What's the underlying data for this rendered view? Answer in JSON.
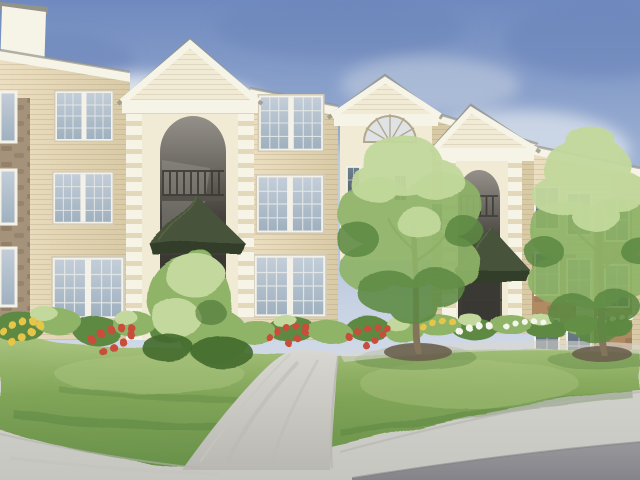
{
  "scene": {
    "description": "Watercolor architectural rendering of a three-story apartment complex with cream gabled entry towers, tan lap siding and stone accents, landscaped lawn with red, yellow and white flower beds, shrubs, two young trees, a curved concrete walkway and a street in the foreground under a hazy blue sky",
    "labels": {
      "sky": "hazy blue watercolor sky with soft clouds",
      "left_wing": "left apartment wing with tan siding and stone column",
      "left_entry": "tall gabled entry tower with arched breezeway, balcony railings and dark green pyramidal awning",
      "center_gable": "center gable tower with semicircular fan window",
      "right_entry": "second gabled entry tower with arch and dark green awning",
      "right_wing": "right apartment wing with stone veneer, partly hidden by a tree",
      "flower_beds": "foundation beds with yellow, red and white flowers",
      "entry_shrub": "bright green shrub in front of the left entry",
      "trees": "two young deciduous trees on lawn mounds",
      "lawn": "green front lawn",
      "walkway": "curved concrete walkway to the entry",
      "street": "light gray street with darker asphalt at lower right"
    }
  },
  "palette": {
    "sky_top": "#6f8abf",
    "sky_mid": "#9fb3d4",
    "sky_pale": "#c9d3e3",
    "sky_white": "#e7ebf1",
    "cloud": "#eef1f4",
    "cloud_shadow": "#ccd5e3",
    "sky_deep": "#6c86ba",
    "trim": "#f6f3e7",
    "cream": "#f1ead5",
    "cream_shadow": "#e3d8ba",
    "siding_light": "#ecdfc1",
    "siding_dark": "#d9caa6",
    "siding_line": "#8f7d5a",
    "roof_edge": "#94938a",
    "stone": "#a5927b",
    "stone_dark": "#7e6a53",
    "stone_warm": "#b08a63",
    "frame": "#f4f1e8",
    "glass_light": "#c3ced9",
    "glass": "#9fb0bf",
    "glass_dark": "#6e7f8e",
    "glass_deep": "#57636e",
    "arch_light": "#95918a",
    "arch_dark": "#45423d",
    "arch_deep": "#3a3833",
    "awning": "#47523a",
    "awning_shadow": "#333d29",
    "awning_light": "#5c6a47",
    "railing": "#3c3a35",
    "grass_light": "#aac47e",
    "grass": "#81a558",
    "grass_dark": "#68914a",
    "grass_deep": "#4d7637",
    "foliage_light": "#c2d89c",
    "foliage": "#8fb468",
    "foliage_dark": "#5d8943",
    "foliage_deep": "#436a2e",
    "trunk": "#84745c",
    "mulch": "#6b604f",
    "flower_red": "#c84e3b",
    "flower_yellow": "#e6c648",
    "flower_white": "#f4f6ee",
    "walk": "#d8d7d1",
    "walk_shadow": "#b9b8b2",
    "street": "#d3d3ce",
    "street_shadow": "#c6c6c1",
    "asphalt": "#98989c",
    "asphalt_dark": "#84848a",
    "curb": "#b4b3ad"
  }
}
